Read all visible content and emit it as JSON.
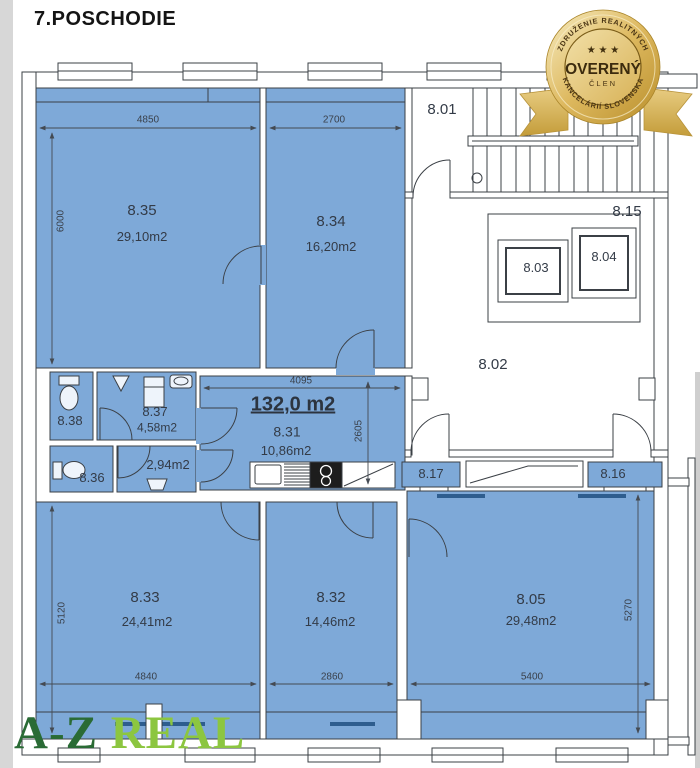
{
  "page": {
    "title": "7.POSCHODIE"
  },
  "badge": {
    "arc_top": "ZDRUŽENIE REALITNÝCH",
    "arc_bottom": "KANCELÁRIÍ SLOVENSKA",
    "stars": "★ ★ ★",
    "title": "OVERENÝ",
    "subtitle": "ČLEN"
  },
  "logo": {
    "part1": "A-Z",
    "part2": "REAL"
  },
  "plan": {
    "total_area": "132,0 m2",
    "rooms": {
      "r835": {
        "id": "8.35",
        "area": "29,10m2"
      },
      "r834": {
        "id": "8.34",
        "area": "16,20m2"
      },
      "r831": {
        "id": "8.31",
        "area": "10,86m2"
      },
      "r837": {
        "id": "8.37",
        "area": "4,58m2"
      },
      "r838": {
        "id": "8.38"
      },
      "r836": {
        "id": "8.36"
      },
      "r294": {
        "area": "2,94m2"
      },
      "r833": {
        "id": "8.33",
        "area": "24,41m2"
      },
      "r832": {
        "id": "8.32",
        "area": "14,46m2"
      },
      "r805": {
        "id": "8.05",
        "area": "29,48m2"
      },
      "r801": {
        "id": "8.01"
      },
      "r802": {
        "id": "8.02"
      },
      "r815": {
        "id": "8.15"
      },
      "r803": {
        "id": "8.03"
      },
      "r804": {
        "id": "8.04"
      },
      "r817": {
        "id": "8.17"
      },
      "r816": {
        "id": "8.16"
      }
    },
    "dims": {
      "d4850": "4850",
      "d2700": "2700",
      "d6000": "6000",
      "d4095": "4095",
      "d2605": "2605",
      "d5120": "5120",
      "d4840": "4840",
      "d2860": "2860",
      "d5400": "5400",
      "d5270": "5270"
    }
  },
  "colors": {
    "room_fill": "#7ea9d8",
    "wall_line": "#3b4046",
    "radiator": "#2e5d8e",
    "gold": "#d6af4e",
    "logo_dark_green": "#2a6b35",
    "logo_light_green": "#8cc640"
  }
}
